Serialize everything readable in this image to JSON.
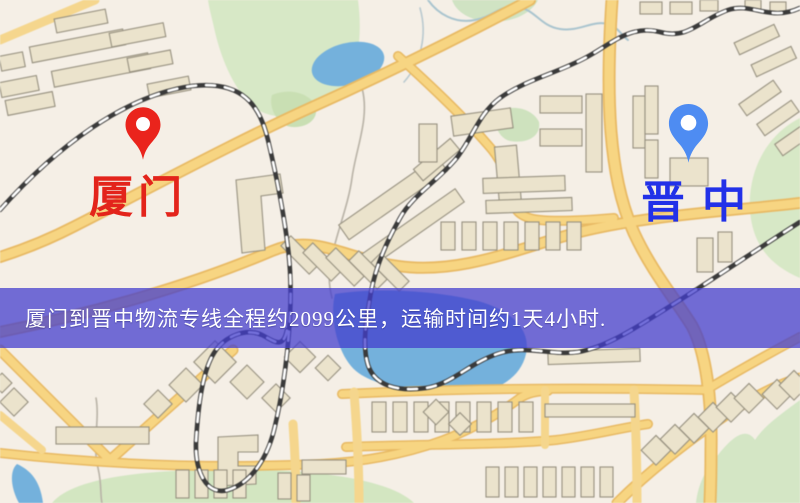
{
  "map": {
    "markers": {
      "origin": {
        "label": "厦门",
        "pin_color": "#ea241c",
        "label_color": "#e3241b"
      },
      "destination": {
        "label": "晋中",
        "pin_color": "#4e8cf2",
        "label_color": "#2231e8"
      }
    },
    "banner": {
      "text": "厦门到晋中物流专线全程约2099公里，运输时间约1天4小时.",
      "text_color": "#ffffff",
      "background_color": "#423dcd",
      "route": {
        "from": "厦门",
        "to": "晋中",
        "distance": "约2099公里",
        "duration": "约1天4小时"
      }
    },
    "palette": {
      "background": "#f5efe6",
      "road": "#f8d57e",
      "road_edge": "#eab95f",
      "building": "#ebe3cb",
      "green_area": "#d7e8c5",
      "water": "#72b1de",
      "railway": "#3a3a3a"
    }
  }
}
